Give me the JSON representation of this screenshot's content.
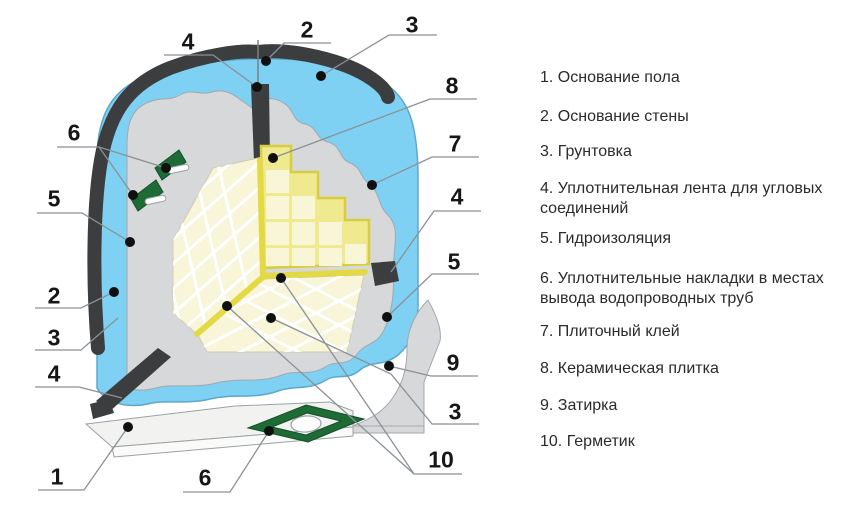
{
  "diagram_subject": "Схема гидроизоляции и облицовки угла санузла",
  "legend": {
    "items": [
      {
        "text": "1. Основание пола"
      },
      {
        "text": "2. Основание стены"
      },
      {
        "text": "3. Грунтовка"
      },
      {
        "text": "4. Уплотнительная лента для угловых соединений"
      },
      {
        "text": "5. Гидроизоляция"
      },
      {
        "text": "6. Уплотнительные накладки в местах вывода водопроводных труб"
      },
      {
        "text": "7. Плиточный клей"
      },
      {
        "text": "8. Керамическая плитка"
      },
      {
        "text": "9. Затирка"
      },
      {
        "text": "10. Герметик"
      }
    ]
  },
  "callouts": {
    "top_4": "4",
    "top_2": "2",
    "top_3": "3",
    "left_6": "6",
    "left_5": "5",
    "left_2": "2",
    "left_3": "3",
    "left_4": "4",
    "left_1": "1",
    "bottom_6": "6",
    "right_8": "8",
    "right_7": "7",
    "right_4": "4",
    "right_5": "5",
    "right_9": "9",
    "right_3": "3",
    "right_10": "10"
  },
  "colors": {
    "waterproofing_blue": "#7ed1f2",
    "adhesive_gray": "#d7d8da",
    "wall_base_dark": "#3c3d3f",
    "tile_cream": "#f8f5d8",
    "sealant_yellow": "#e3d945",
    "backing_yellow": "#efe98f",
    "gasket_green": "#1e6b35",
    "leader_line": "#8b9197"
  }
}
